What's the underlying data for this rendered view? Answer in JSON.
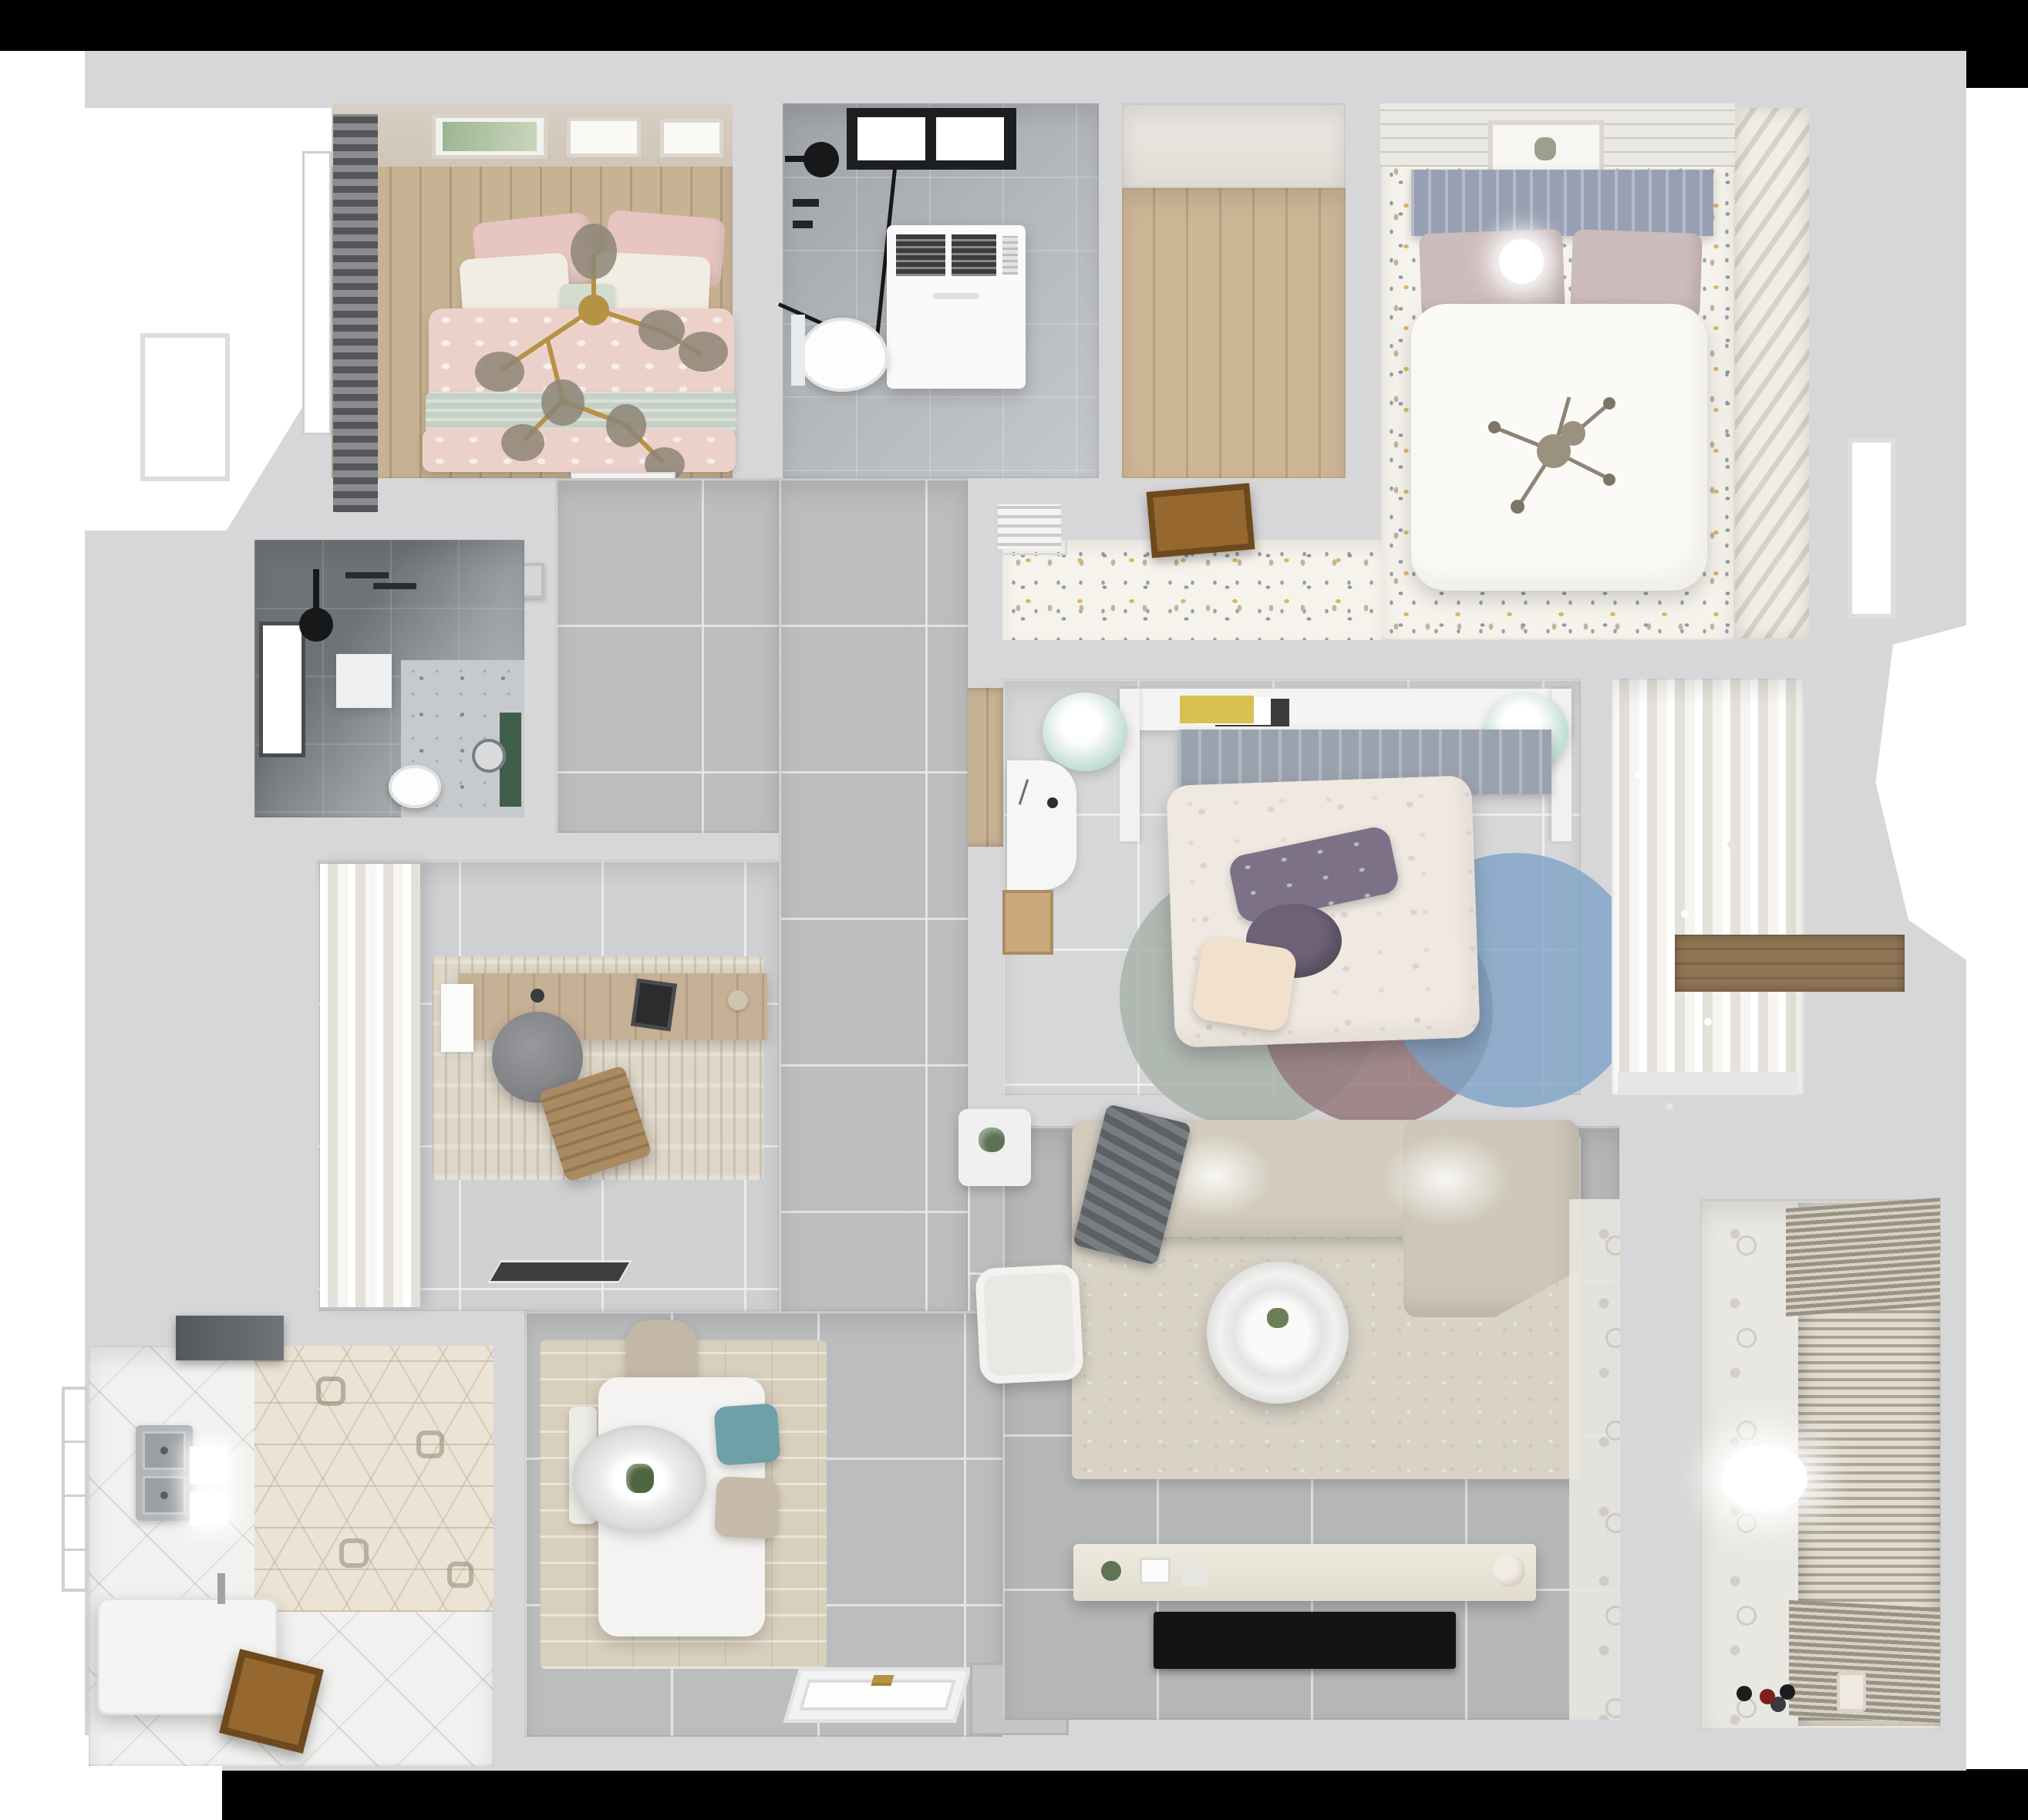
{
  "scene": {
    "title": "Top-down 3D render of an apartment floor plan",
    "type": "architectural render, no visible text",
    "background": "#ffffff"
  },
  "palette": {
    "black": "#000000",
    "white": "#ffffff",
    "wall": "#d7d7d9",
    "hall": "#bcbdbf",
    "livingTile": "#b5b6b8",
    "wood": "#c8b294",
    "doorWood": "#96672f",
    "confettiBase": "#f6f3ec",
    "pinkDuvet": "#ecd1cb",
    "mintBlanket": "#c6d1c6",
    "headboardBlue": "#97a0b2",
    "tealStool": "#cfe4df",
    "tealChair": "#6fa0a8",
    "purplePillow": "#7c7186",
    "rugBlue": "#7ea4c7",
    "rugMauve": "#96797e",
    "rugSage": "#a9b3aa",
    "sofaBeige": "#d3ccbe",
    "gold": "#b59344",
    "steel": "#b3b6b9",
    "darkBathTile": "#6f7377",
    "greenAccent": "#3f5e4c",
    "tvBlack": "#131416"
  },
  "rooms": [
    {
      "label": "Bedroom with pink bed",
      "furniture": "double bed, pink patterned duvet, mint throw, pillows, gold branch chandelier, dark roller blinds, window, gallery frames, white dresser"
    },
    {
      "label": "Main bathroom",
      "furniture": "black-framed window, black rain shower, glass shower screen, washing machine, toilet"
    },
    {
      "label": "Empty walk-in room",
      "furniture": "wood plank floor"
    },
    {
      "label": "Master bedroom",
      "furniture": "white bed, blue-gray headboard, pink pillows, sputnik chandelier, ball lamp, confetti floor, vertical blinds, picture frame, air vent, open wooden door"
    },
    {
      "label": "Second bedroom",
      "furniture": "floral duvet bed, purple pillows, wall shelf with books, two teal stools, white desk, round rugs blue mauve sage, sheer-curtain wardrobe, wood niche"
    },
    {
      "label": "Living room",
      "furniture": "L-shaped beige sofa, gray throw, round coffee table, white armchair, plant side table, TV sideboard, wall TV, large beige rug"
    },
    {
      "label": "Dining area",
      "furniture": "white dining table, oval pendant with plant, teal chair, beige chairs, white bench, wood mat"
    },
    {
      "label": "Kitchen",
      "furniture": "double stainless sink, range hood, hexagon accent tiles, white island block, open wood door, window"
    },
    {
      "label": "Small shower room",
      "furniture": "dark tiles, window, black shower head, white shelf, toilet, marble floor, green accent"
    },
    {
      "label": "Study",
      "furniture": "sheer white curtains, wooden desk, laptop, gray swivel chair, wooden lounge chair, beige rug, dark doormat"
    },
    {
      "label": "Hallway",
      "furniture": "gray porcelain tiles, front door with gold handle, switch box"
    },
    {
      "label": "Balcony",
      "furniture": "patterned tiles, stacked blinds drying rack, oval ceiling light, toys"
    }
  ]
}
